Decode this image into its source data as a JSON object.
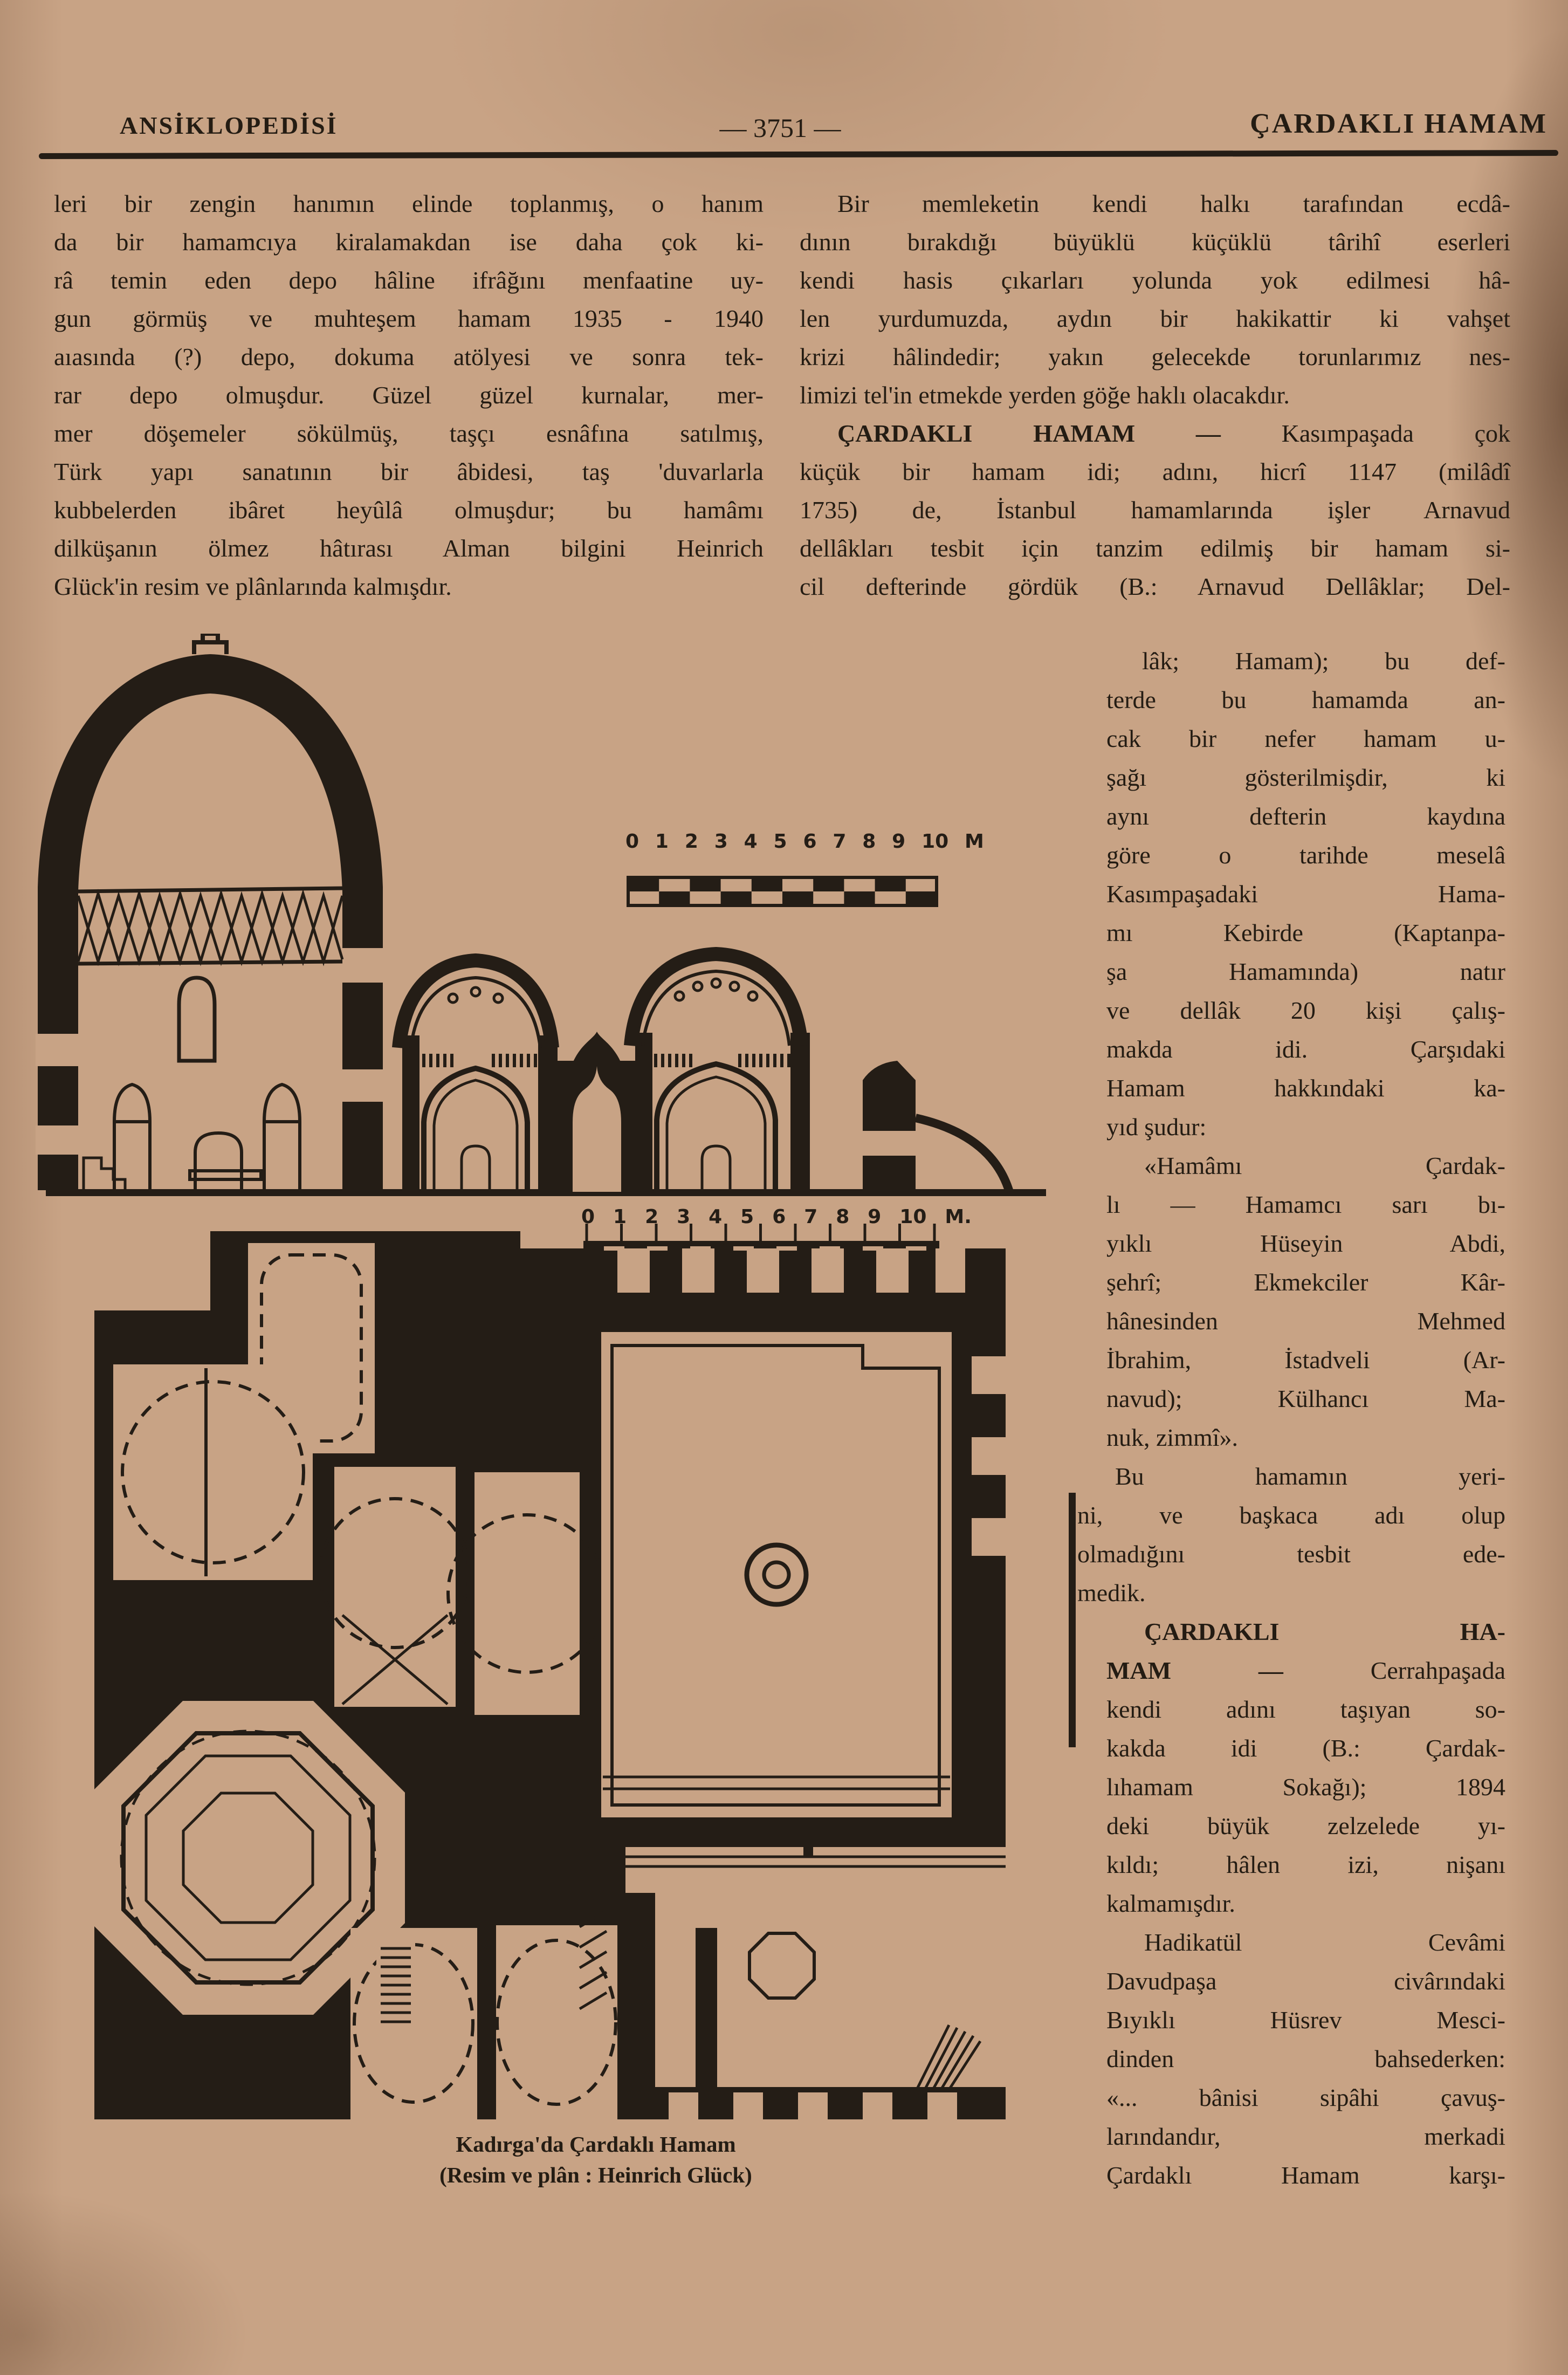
{
  "header": {
    "left_title": "ANSİKLOPEDİSİ",
    "page_number": "— 3751 —",
    "right_title": "ÇARDAKLI HAMAM"
  },
  "columns": {
    "left": {
      "lines": [
        {
          "t": "leri bir zengin hanımın elinde toplanmış, o hanım"
        },
        {
          "t": "da bir hamamcıya kiralamakdan ise daha çok ki-"
        },
        {
          "t": "râ temin eden depo hâline ifrâğını menfaatine uy-"
        },
        {
          "t": "gun görmüş ve muhteşem hamam  1935 - 1940"
        },
        {
          "t": "aıasında (?) depo, dokuma atölyesi ve sonra tek-"
        },
        {
          "t": "rar depo olmuşdur. Güzel güzel kurnalar, mer-"
        },
        {
          "t": "mer döşemeler sökülmüş, taşçı esnâfına satılmış,"
        },
        {
          "t": "Türk yapı sanatının bir âbidesi, taş 'duvarlarla"
        },
        {
          "t": "kubbelerden ibâret heyûlâ olmuşdur; bu hamâmı"
        },
        {
          "t": "dilküşanın ölmez hâtırası Alman bilgini Heinrich"
        },
        {
          "t": "Glück'in resim ve plânlarında kalmışdır.",
          "cls": "end"
        }
      ]
    },
    "right_wide": {
      "lines": [
        {
          "t": "Bir memleketin kendi halkı tarafından ecdâ-",
          "cls": "ind"
        },
        {
          "t": "dının bırakdığı büyüklü  küçüklü târihî  eserleri"
        },
        {
          "t": "kendi hasis çıkarları yolunda yok  edilmesi  hâ-"
        },
        {
          "t": "len yurdumuzda, aydın bir hakikattir ki  vahşet"
        },
        {
          "t": "krizi hâlindedir; yakın gelecekde torunlarımız nes-"
        },
        {
          "t": "limizi tel'in etmekde yerden göğe haklı olacakdır.",
          "cls": "end"
        },
        {
          "b": "ÇARDAKLI HAMAM — ",
          "t": "Kasımpaşada çok",
          "cls": "ind"
        },
        {
          "t": "küçük bir hamam idi; adını, hicrî 1147 (milâdî"
        },
        {
          "t": "1735) de, İstanbul hamamlarında işler Arnavud"
        },
        {
          "t": "dellâkları tesbit için tanzim edilmiş bir hamam si-"
        },
        {
          "t": "cil defterinde gördük (B.: Arnavud Dellâklar; Del-"
        }
      ]
    },
    "right_narrow": {
      "lines": [
        {
          "t": "lâk; Hamam); bu def-",
          "cls": "shift"
        },
        {
          "t": "terde bu hamamda an-"
        },
        {
          "t": "cak bir nefer hamam u-"
        },
        {
          "t": "şağı gösterilmişdir, ki"
        },
        {
          "t": "aynı defterin kaydına"
        },
        {
          "t": "göre o tarihde meselâ"
        },
        {
          "t": "Kasımpaşadaki Hama-"
        },
        {
          "t": "mı Kebirde (Kaptanpa-"
        },
        {
          "t": "şa Hamamında) natır"
        },
        {
          "t": "ve dellâk 20 kişi çalış-"
        },
        {
          "t": "makda idi. Çarşıdaki"
        },
        {
          "t": "Hamam hakkındaki ka-"
        },
        {
          "t": "yıd şudur:",
          "cls": "end"
        },
        {
          "t": "«Hamâmı Çardak-",
          "cls": "ind"
        },
        {
          "t": "lı — Hamamcı sarı bı-"
        },
        {
          "t": "yıklı Hüseyin Abdi,"
        },
        {
          "t": "şehrî; Ekmekciler Kâr-"
        },
        {
          "t": "hânesinden Mehmed"
        },
        {
          "t": "İbrahim, İstadveli (Ar-"
        },
        {
          "t": "navud); Külhancı Ma-"
        },
        {
          "t": "nuk, zimmî».",
          "cls": "end"
        },
        {
          "t": "Bu hamamın yeri-",
          "cls": "ind out"
        },
        {
          "t": "ni, ve başkaca adı olup",
          "cls": "out"
        },
        {
          "t": "olmadığını tesbit ede-",
          "cls": "out"
        },
        {
          "t": "medik.",
          "cls": "end out"
        },
        {
          "b": "ÇARDAKLI HA-",
          "cls": "ind"
        },
        {
          "b": "MAM — ",
          "t": "Cerrahpaşada"
        },
        {
          "t": "kendi adını taşıyan so-"
        },
        {
          "t": "kakda idi (B.: Çardak-"
        },
        {
          "t": "lıhamam Sokağı); 1894"
        },
        {
          "t": "deki büyük zelzelede yı-"
        },
        {
          "t": "kıldı; hâlen izi, nişanı"
        },
        {
          "t": "kalmamışdır.",
          "cls": "end"
        },
        {
          "t": "Hadikatül Cevâmi",
          "cls": "ind"
        },
        {
          "t": "Davudpaşa civârındaki"
        },
        {
          "t": "Bıyıklı Hüsrev Mesci-"
        },
        {
          "t": "dinden bahsederken:"
        },
        {
          "t": "«... bânisi sipâhi çavuş-"
        },
        {
          "t": "larındandır, merkadi"
        },
        {
          "t": "Çardaklı Hamam karşı-"
        }
      ]
    }
  },
  "figure": {
    "section_scale_labels": [
      "0",
      "1",
      "2",
      "3",
      "4",
      "5",
      "6",
      "7",
      "8",
      "9",
      "10",
      "M"
    ],
    "plan_scale_labels": [
      "0",
      "1",
      "2",
      "3",
      "4",
      "5",
      "6",
      "7",
      "8",
      "9",
      "10",
      "M."
    ],
    "caption_line1": "Kadırga'da Çardaklı Hamam",
    "caption_line2": "(Resim ve plân :  Heinrich Glück)"
  }
}
